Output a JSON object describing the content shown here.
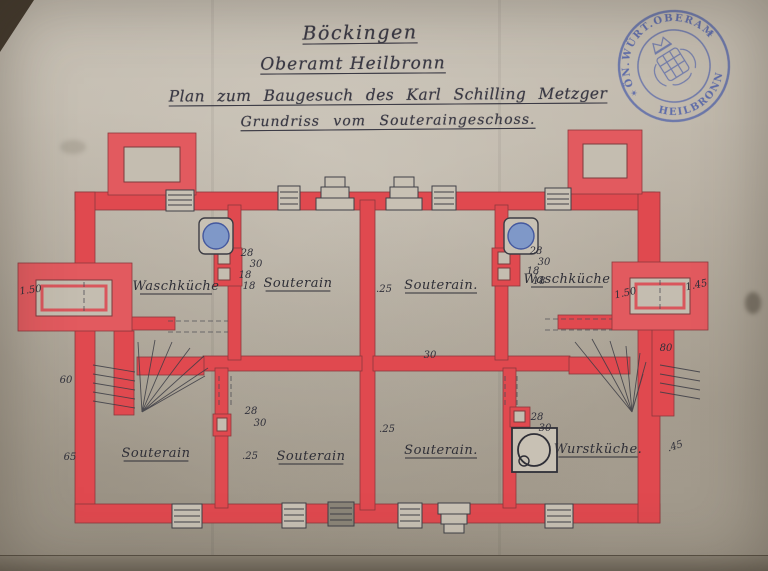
{
  "document": {
    "line1": "Böckingen",
    "line2": "Oberamt Heilbronn",
    "line3": "Plan zum Baugesuch des Karl Schilling Metzger",
    "line4": "Grundriss vom Souteraingeschoss."
  },
  "stamp": {
    "arc_text": "KÖN.WÜRT.OBERAMT",
    "bottom_text": "HEILBRONN",
    "star_left": "✶",
    "star_right": "✶",
    "ink_color": "#4d5fa9"
  },
  "plan": {
    "wall_color": "#e0494f",
    "ink_color": "#30303a",
    "kettle_blue": "#7f98c8",
    "rooms": [
      {
        "id": "room-top-left",
        "label": "Waschküche",
        "x": 176,
        "y": 290
      },
      {
        "id": "room-top-mid-left",
        "label": "Souterain",
        "x": 298,
        "y": 287
      },
      {
        "id": "room-top-mid-right",
        "label": "Souterain.",
        "x": 441,
        "y": 289
      },
      {
        "id": "room-top-right",
        "label": "Waschküche",
        "x": 567,
        "y": 283
      },
      {
        "id": "room-bottom-left",
        "label": "Souterain",
        "x": 156,
        "y": 457
      },
      {
        "id": "room-bottom-mid-left",
        "label": "Souterain",
        "x": 311,
        "y": 460
      },
      {
        "id": "room-bottom-mid-right",
        "label": "Souterain.",
        "x": 441,
        "y": 454
      },
      {
        "id": "room-bottom-right",
        "label": "Wurstküche.",
        "x": 598,
        "y": 453
      }
    ],
    "annotations": [
      {
        "text": "28",
        "x": 247,
        "y": 256
      },
      {
        "text": "30",
        "x": 256,
        "y": 267
      },
      {
        "text": "18",
        "x": 245,
        "y": 278
      },
      {
        "text": "18",
        "x": 249,
        "y": 289
      },
      {
        "text": ".25",
        "x": 384,
        "y": 292
      },
      {
        "text": "28",
        "x": 536,
        "y": 254
      },
      {
        "text": "30",
        "x": 544,
        "y": 265
      },
      {
        "text": "18",
        "x": 533,
        "y": 274
      },
      {
        "text": "18",
        "x": 539,
        "y": 284
      },
      {
        "text": "1.50",
        "x": 626,
        "y": 296,
        "rot": -12
      },
      {
        "text": "1.45",
        "x": 697,
        "y": 288,
        "rot": -12
      },
      {
        "text": "1.50",
        "x": 31,
        "y": 293,
        "rot": -8
      },
      {
        "text": "60",
        "x": 66,
        "y": 383
      },
      {
        "text": "80",
        "x": 666,
        "y": 351
      },
      {
        "text": "30",
        "x": 430,
        "y": 358
      },
      {
        "text": "28",
        "x": 251,
        "y": 414
      },
      {
        "text": "30",
        "x": 260,
        "y": 426
      },
      {
        "text": ".25",
        "x": 250,
        "y": 459
      },
      {
        "text": ".25",
        "x": 387,
        "y": 432
      },
      {
        "text": "28",
        "x": 537,
        "y": 420
      },
      {
        "text": "30",
        "x": 545,
        "y": 431
      },
      {
        "text": "65",
        "x": 70,
        "y": 460
      },
      {
        "text": ".45",
        "x": 676,
        "y": 449,
        "rot": -18
      }
    ]
  }
}
